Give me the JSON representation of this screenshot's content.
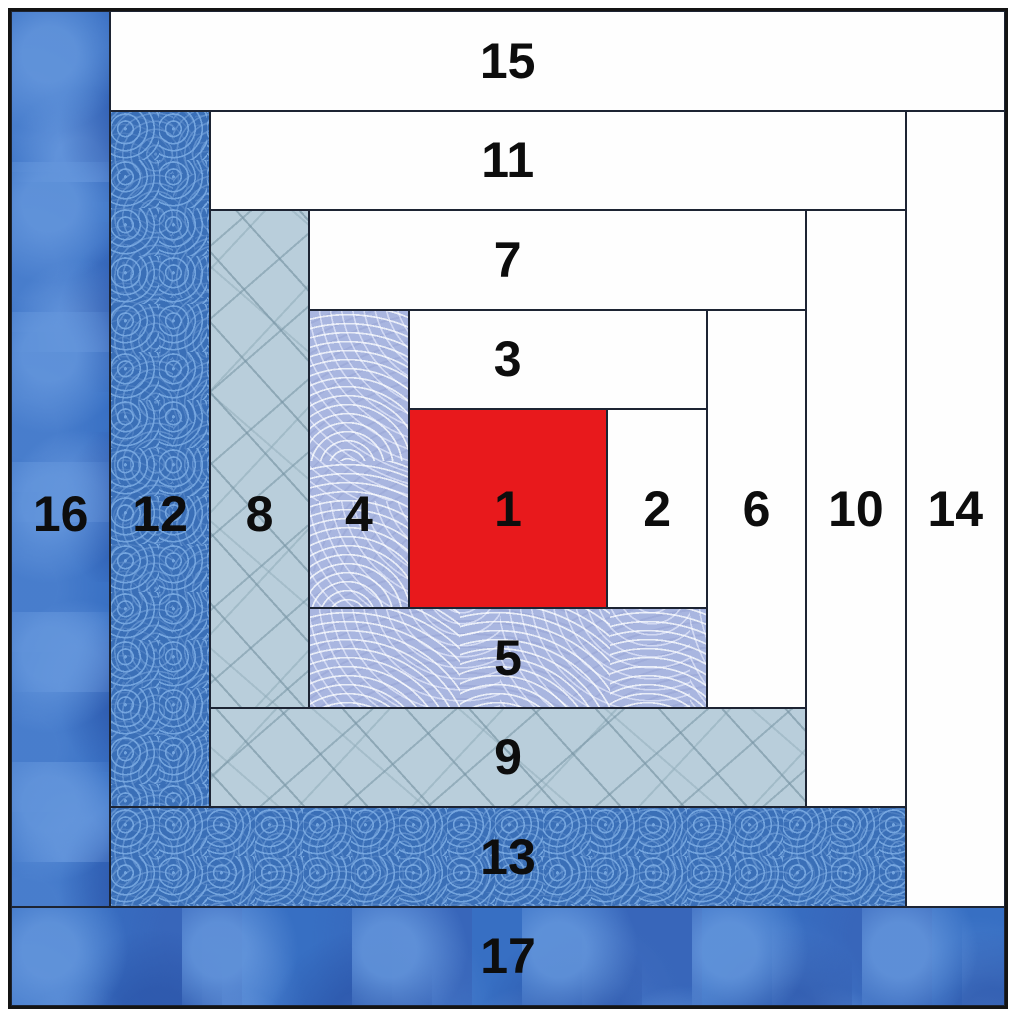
{
  "title": "Log cabin quilt block piecing diagram",
  "block": {
    "grid_units": 10,
    "piece_count": 17,
    "seam_color": "#1d2433",
    "outer_border_color": "#141414",
    "label_color": "#0d0d0d"
  },
  "fabrics": {
    "red_solid": {
      "label": "red solid center",
      "hex": "#e8191c"
    },
    "white_solid": {
      "label": "white solid",
      "hex": "#fefefe"
    },
    "clamshell_print": {
      "label": "periwinkle clamshell print",
      "hex": "#a9b6e0"
    },
    "sprig_print": {
      "label": "light blue sprig print",
      "hex": "#b9cedb"
    },
    "swirl_print": {
      "label": "medium blue swirl print",
      "hex": "#3a6fb7"
    },
    "marbled_print": {
      "label": "dark marbled blue print",
      "hex": "#376fc3"
    }
  },
  "pieces": [
    {
      "num": "1",
      "fabric": "red_solid",
      "position": "center"
    },
    {
      "num": "2",
      "fabric": "white_solid",
      "position": "right of center"
    },
    {
      "num": "3",
      "fabric": "white_solid",
      "position": "above center"
    },
    {
      "num": "4",
      "fabric": "clamshell_print",
      "position": "left of center"
    },
    {
      "num": "5",
      "fabric": "clamshell_print",
      "position": "below center"
    },
    {
      "num": "6",
      "fabric": "white_solid",
      "position": "right, round 2"
    },
    {
      "num": "7",
      "fabric": "white_solid",
      "position": "top, round 2"
    },
    {
      "num": "8",
      "fabric": "sprig_print",
      "position": "left, round 2"
    },
    {
      "num": "9",
      "fabric": "sprig_print",
      "position": "bottom, round 2"
    },
    {
      "num": "10",
      "fabric": "white_solid",
      "position": "right, round 3"
    },
    {
      "num": "11",
      "fabric": "white_solid",
      "position": "top, round 3"
    },
    {
      "num": "12",
      "fabric": "swirl_print",
      "position": "left, round 3"
    },
    {
      "num": "13",
      "fabric": "swirl_print",
      "position": "bottom, round 3"
    },
    {
      "num": "14",
      "fabric": "white_solid",
      "position": "right, round 4"
    },
    {
      "num": "15",
      "fabric": "white_solid",
      "position": "top, round 4"
    },
    {
      "num": "16",
      "fabric": "marbled_print",
      "position": "left, round 4"
    },
    {
      "num": "17",
      "fabric": "marbled_print",
      "position": "bottom, round 4"
    }
  ]
}
